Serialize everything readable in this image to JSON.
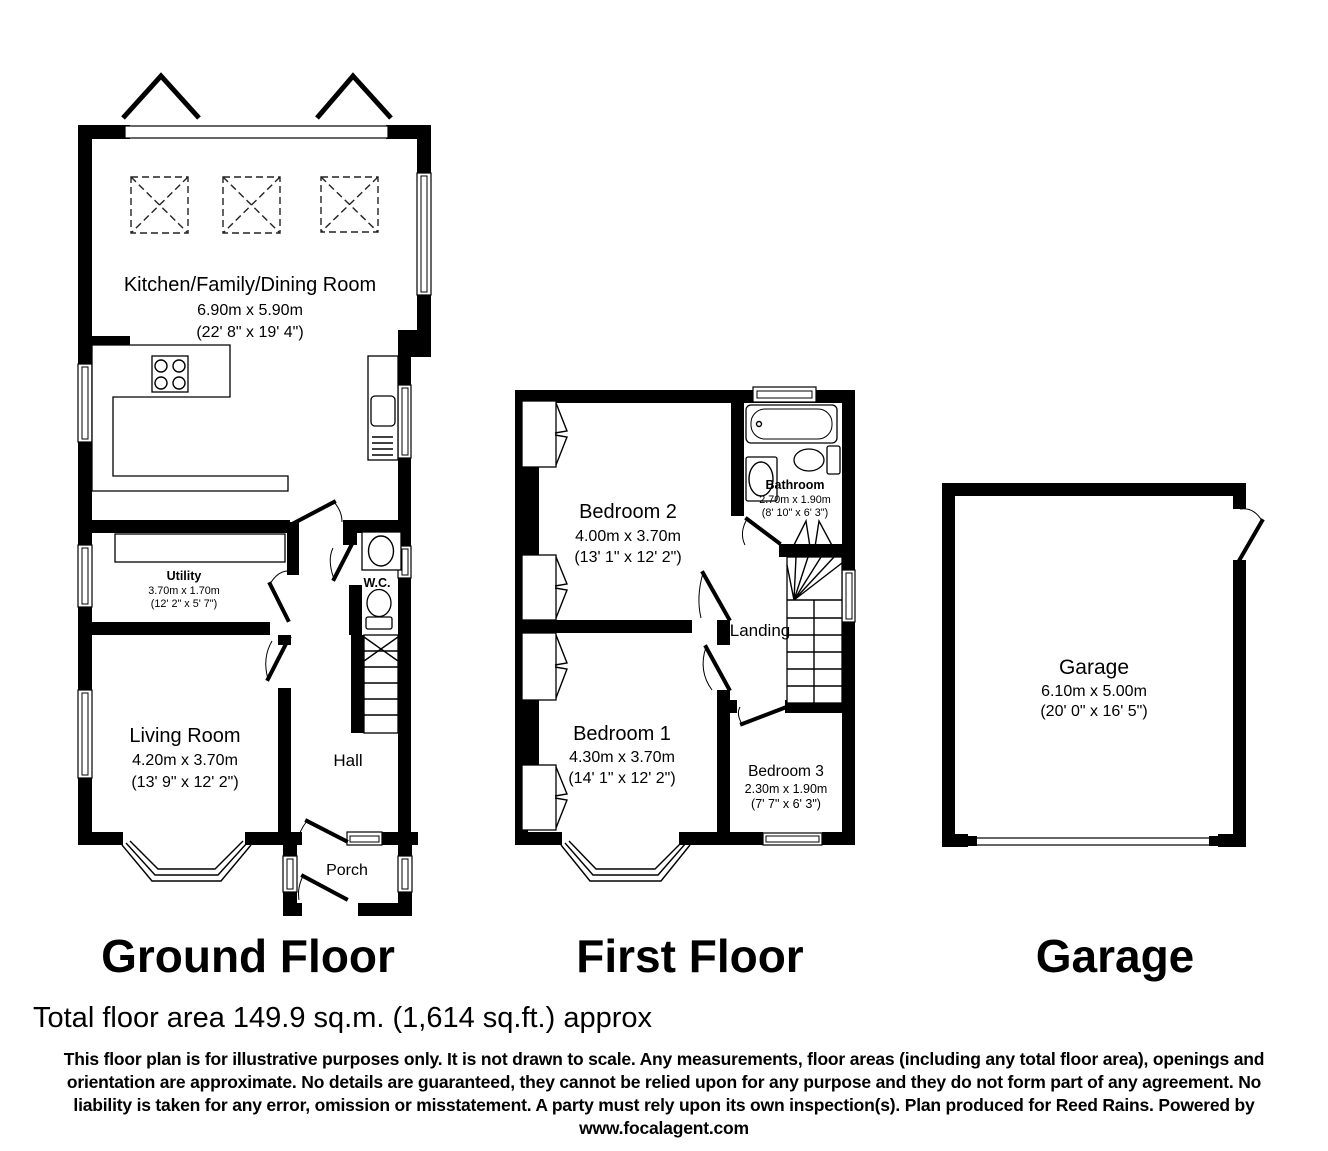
{
  "palette": {
    "wall": "#000000",
    "background": "#ffffff",
    "line": "#000000"
  },
  "icons": {
    "rooflight": "dashed-square-with-x",
    "roof": "chevron-arrow",
    "hob": "four-burner-circles",
    "sink": "rounded-rect-with-drainer",
    "stairs": "tread-lines",
    "bath": "rounded-rectangle",
    "toilet": "oval-with-cistern",
    "basin": "oval-in-rect",
    "wardrobe": "double-leaf-chevron",
    "bay-window": "angled-triple-line",
    "window": "double-line",
    "door": "leaf-with-arc"
  },
  "floors": {
    "ground": {
      "title": "Ground Floor",
      "kitchen_name": "Kitchen/Family/Dining Room",
      "kitchen_m": "6.90m x 5.90m",
      "kitchen_ft": "(22' 8\" x 19' 4\")",
      "utility_name": "Utility",
      "utility_m": "3.70m x 1.70m",
      "utility_ft": "(12' 2\" x 5' 7\")",
      "wc_name": "W.C.",
      "living_name": "Living Room",
      "living_m": "4.20m x 3.70m",
      "living_ft": "(13' 9\" x 12' 2\")",
      "hall_name": "Hall",
      "porch_name": "Porch"
    },
    "first": {
      "title": "First Floor",
      "bedroom2_name": "Bedroom 2",
      "bedroom2_m": "4.00m x 3.70m",
      "bedroom2_ft": "(13' 1\" x 12' 2\")",
      "bathroom_name": "Bathroom",
      "bathroom_m": "2.70m x 1.90m",
      "bathroom_ft": "(8' 10\" x 6' 3\")",
      "landing_name": "Landing",
      "bedroom1_name": "Bedroom 1",
      "bedroom1_m": "4.30m x 3.70m",
      "bedroom1_ft": "(14' 1\" x 12' 2\")",
      "bedroom3_name": "Bedroom 3",
      "bedroom3_m": "2.30m x 1.90m",
      "bedroom3_ft": "(7' 7\" x 6' 3\")"
    },
    "garage": {
      "title": "Garage",
      "garage_name": "Garage",
      "garage_m": "6.10m x 5.00m",
      "garage_ft": "(20' 0\" x 16' 5\")"
    }
  },
  "footer": {
    "total_area": "Total floor area 149.9 sq.m. (1,614 sq.ft.) approx",
    "disclaimer_lines": [
      "This floor plan is for illustrative purposes only. It is not drawn to scale. Any measurements, floor areas (including any total floor area), openings and",
      "orientation are approximate. No details are guaranteed, they cannot be relied upon for any purpose and they do not form part of any agreement. No",
      "liability is taken for any error, omission or misstatement. A party must rely upon its own inspection(s). Plan produced for Reed Rains. Powered by",
      "www.focalagent.com"
    ]
  }
}
